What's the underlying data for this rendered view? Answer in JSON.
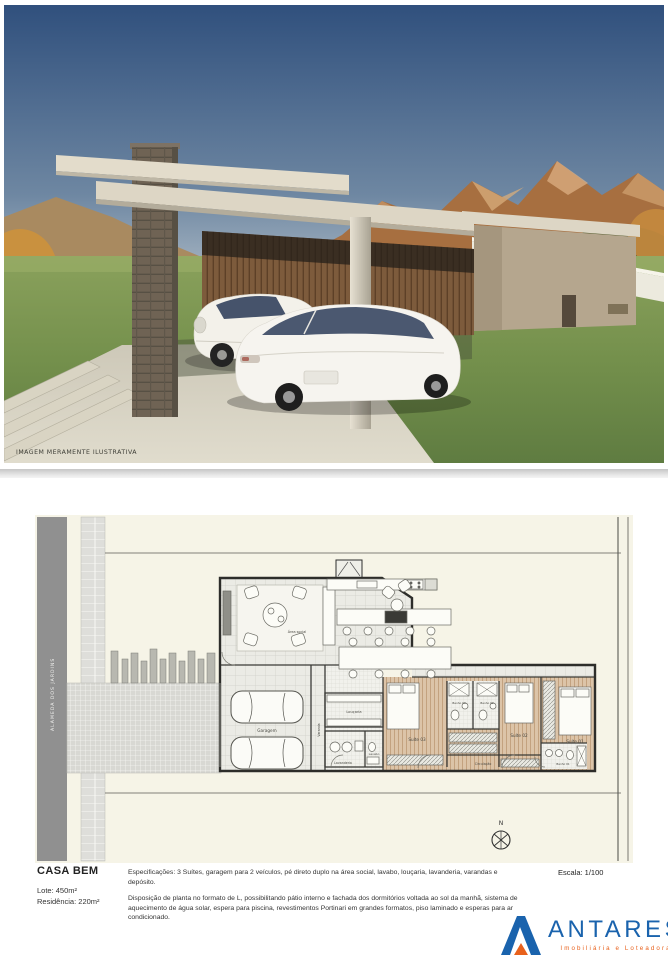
{
  "hero": {
    "caption": "IMAGEM MERAMENTE ILUSTRATIVA"
  },
  "plan": {
    "street_label": "ALAMEDA DOS JARDINS",
    "compass": "N",
    "rooms": {
      "garagem": "Garagem",
      "varanda": "Varanda",
      "loucaria": "Louçaria",
      "lavanderia": "Lavanderia",
      "lavabo": "Lavabo",
      "area_social": "Área social",
      "suite1": "Suíte 01",
      "suite2": "Suíte 02",
      "suite3": "Suíte 03",
      "banho1": "Banho 01",
      "banho2": "Banho 02",
      "banho3": "Banho 03",
      "circulacao": "Circulação"
    }
  },
  "footer": {
    "title": "CASA BEM",
    "lot": "Lote: 450m²",
    "residence": "Residência: 220m²",
    "spec1": "Especificações: 3 Suítes, garagem para 2 veículos, pé direto duplo na área social, lavabo, louçaria, lavanderia, varandas e depósito.",
    "spec2": "Disposição de planta no formato de L, possibilitando pátio interno e fachada dos dormitórios voltada ao sol da manhã, sistema de aquecimento de água solar, espera para piscina, revestimentos Portinari em grandes formatos, piso laminado e esperas para ar condicionado.",
    "scale": "Escala: 1/100"
  },
  "logo": {
    "name": "ANTARES",
    "tagline": "Imobiliária e Loteadora",
    "colors": {
      "blue": "#1a63ad",
      "orange": "#e8611c"
    }
  }
}
